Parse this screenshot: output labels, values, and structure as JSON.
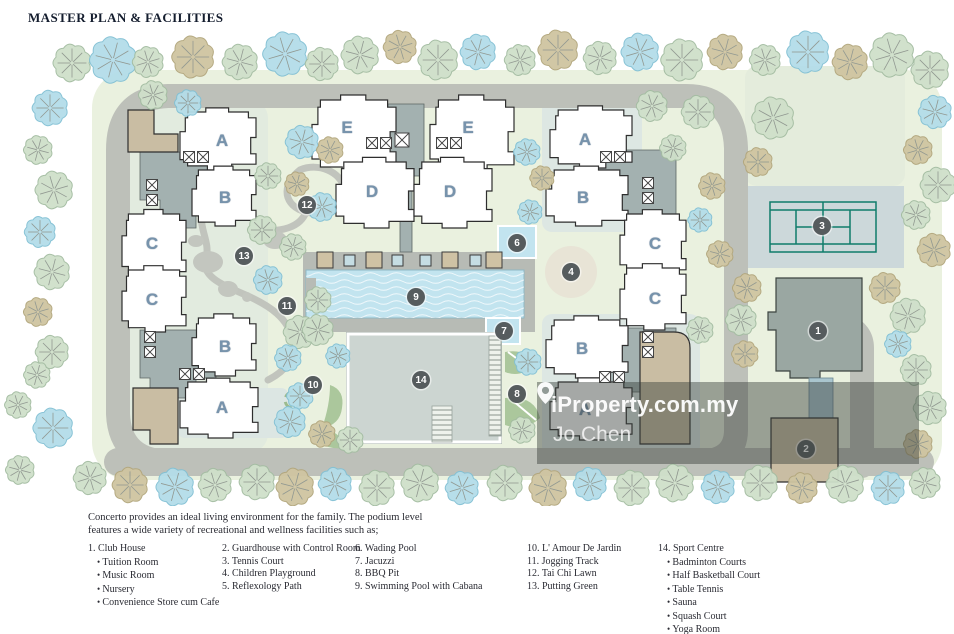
{
  "title": "MASTER PLAN & FACILITIES",
  "intro": "Concerto provides an ideal living environment for the family. The podium level\nfeatures a wide variety of recreational and wellness facilities such as;",
  "watermark": {
    "brand": "iProperty.com.my",
    "agent": "Jo Chen",
    "icon": "map-pin-icon"
  },
  "legend": {
    "columns": [
      {
        "x": 88,
        "items": [
          {
            "num": "1.",
            "label": "Club House",
            "bullets": [
              "Tuition Room",
              "Music Room",
              "Nursery",
              "Convenience Store cum Cafe"
            ]
          }
        ]
      },
      {
        "x": 222,
        "items": [
          {
            "num": "2.",
            "label": "Guardhouse with Control Room"
          },
          {
            "num": "3.",
            "label": "Tennis Court"
          },
          {
            "num": "4.",
            "label": "Children Playground"
          },
          {
            "num": "5.",
            "label": "Reflexology Path"
          }
        ]
      },
      {
        "x": 355,
        "items": [
          {
            "num": "6.",
            "label": "Wading Pool"
          },
          {
            "num": "7.",
            "label": "Jacuzzi"
          },
          {
            "num": "8.",
            "label": "BBQ Pit"
          },
          {
            "num": "9.",
            "label": "Swimming Pool with Cabana"
          }
        ]
      },
      {
        "x": 527,
        "items": [
          {
            "num": "10.",
            "label": "L' Amour De Jardin"
          },
          {
            "num": "11.",
            "label": "Jogging Track"
          },
          {
            "num": "12.",
            "label": "Tai Chi Lawn"
          },
          {
            "num": "13.",
            "label": "Putting Green"
          }
        ]
      },
      {
        "x": 658,
        "items": [
          {
            "num": "14.",
            "label": "Sport Centre",
            "bullets": [
              "Badminton Courts",
              "Half Basketball Court",
              "Table Tennis",
              "Sauna",
              "Squash Court",
              "Yoga Room",
              "Gymnasium"
            ]
          }
        ]
      }
    ]
  },
  "plan": {
    "building_labels": [
      {
        "label": "A",
        "x": 222,
        "y": 115
      },
      {
        "label": "B",
        "x": 225,
        "y": 172
      },
      {
        "label": "C",
        "x": 152,
        "y": 218
      },
      {
        "label": "C",
        "x": 152,
        "y": 274
      },
      {
        "label": "B",
        "x": 225,
        "y": 321
      },
      {
        "label": "A",
        "x": 222,
        "y": 382
      },
      {
        "label": "E",
        "x": 347,
        "y": 102
      },
      {
        "label": "E",
        "x": 468,
        "y": 102
      },
      {
        "label": "D",
        "x": 372,
        "y": 166
      },
      {
        "label": "D",
        "x": 450,
        "y": 166
      },
      {
        "label": "A",
        "x": 585,
        "y": 114
      },
      {
        "label": "B",
        "x": 583,
        "y": 172
      },
      {
        "label": "C",
        "x": 655,
        "y": 218
      },
      {
        "label": "C",
        "x": 655,
        "y": 273
      },
      {
        "label": "B",
        "x": 582,
        "y": 323
      },
      {
        "label": "A",
        "x": 585,
        "y": 384
      }
    ],
    "facility_markers": [
      {
        "num": "1",
        "x": 818,
        "y": 305
      },
      {
        "num": "2",
        "x": 806,
        "y": 423
      },
      {
        "num": "3",
        "x": 822,
        "y": 200
      },
      {
        "num": "4",
        "x": 571,
        "y": 246
      },
      {
        "num": "6",
        "x": 517,
        "y": 217
      },
      {
        "num": "7",
        "x": 504,
        "y": 305
      },
      {
        "num": "8",
        "x": 517,
        "y": 368
      },
      {
        "num": "9",
        "x": 416,
        "y": 271
      },
      {
        "num": "10",
        "x": 313,
        "y": 359
      },
      {
        "num": "11",
        "x": 287,
        "y": 280
      },
      {
        "num": "12",
        "x": 307,
        "y": 179
      },
      {
        "num": "13",
        "x": 244,
        "y": 230
      },
      {
        "num": "14",
        "x": 421,
        "y": 354
      }
    ],
    "colors": {
      "site_green": "#eaf1df",
      "road_gray": "#bdc0b9",
      "pool_blue": "#c2e4ef",
      "tan_building": "#c9bda3",
      "core_gray": "#a3b1b0",
      "clubhouse_gray": "#9aa7a2",
      "tennis_line_teal": "#0e7c6b",
      "marker_bg": "#565c5e",
      "label_blue": "#7793ac",
      "tree_green": "#cfe0ca",
      "tree_blue": "#b4dde9",
      "tree_tan": "#cfc5a1"
    }
  }
}
